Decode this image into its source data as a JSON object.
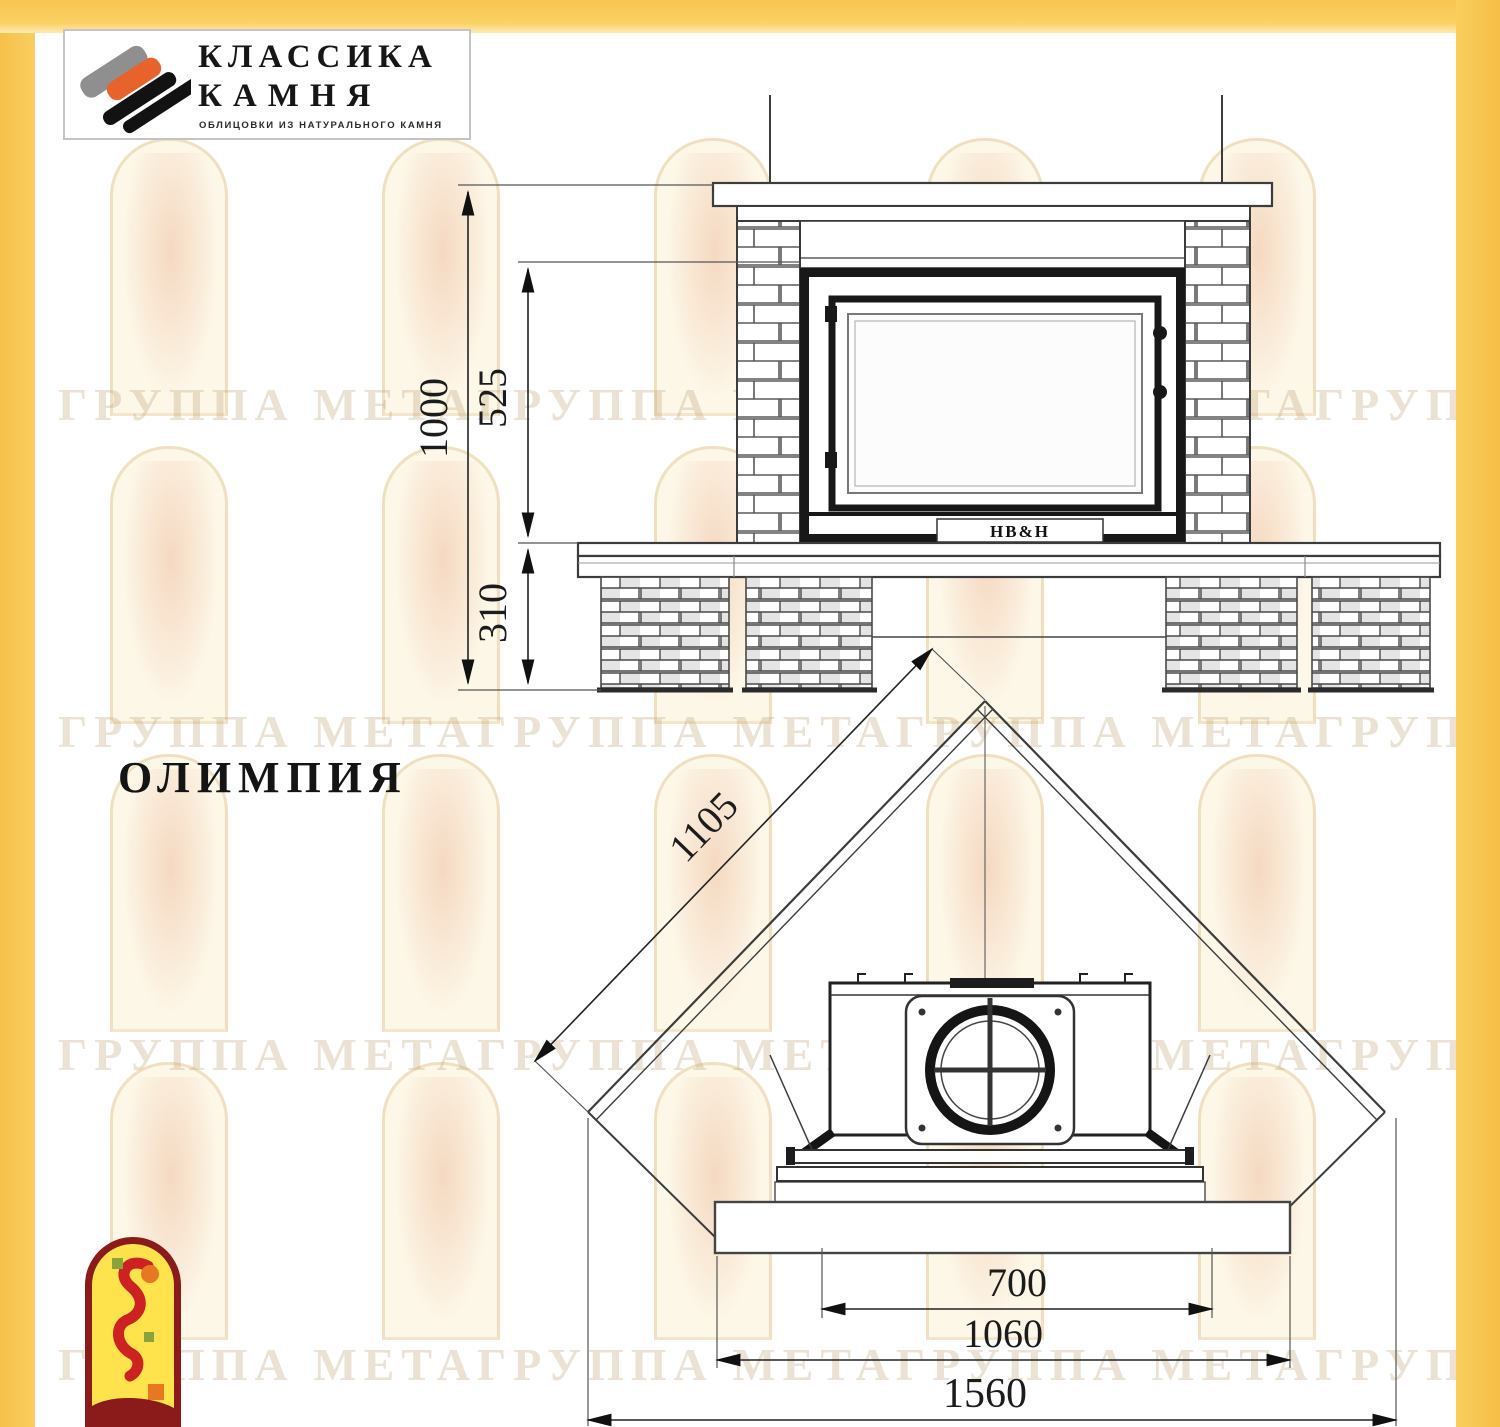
{
  "branding": {
    "logo_title_line1": "КЛАССИКА",
    "logo_title_line2": "КАМНЯ",
    "logo_subtitle": "ОБЛИЦОВКИ ИЗ НАТУРАЛЬНОГО КАМНЯ"
  },
  "model": {
    "name": "ОЛИМПИЯ"
  },
  "front_view": {
    "dims": {
      "total_height": "1000",
      "firebox_height": "525",
      "base_height": "310"
    },
    "insert_brand": "НВ&Н"
  },
  "plan_view": {
    "dims": {
      "side_diagonal": "1105",
      "opening_width": "700",
      "hearth_width": "1060",
      "overall_width": "1560"
    }
  },
  "watermark": {
    "row_text": "ГРУППА МЕТАГРУППА МЕТАГРУППА МЕТАГРУППА МЕТА"
  },
  "colors": {
    "frame_yellow": "#F7C857",
    "logo_orange": "#E8622B",
    "mascot_red": "#8B1A1A",
    "line_dark": "#3C3C3C"
  }
}
